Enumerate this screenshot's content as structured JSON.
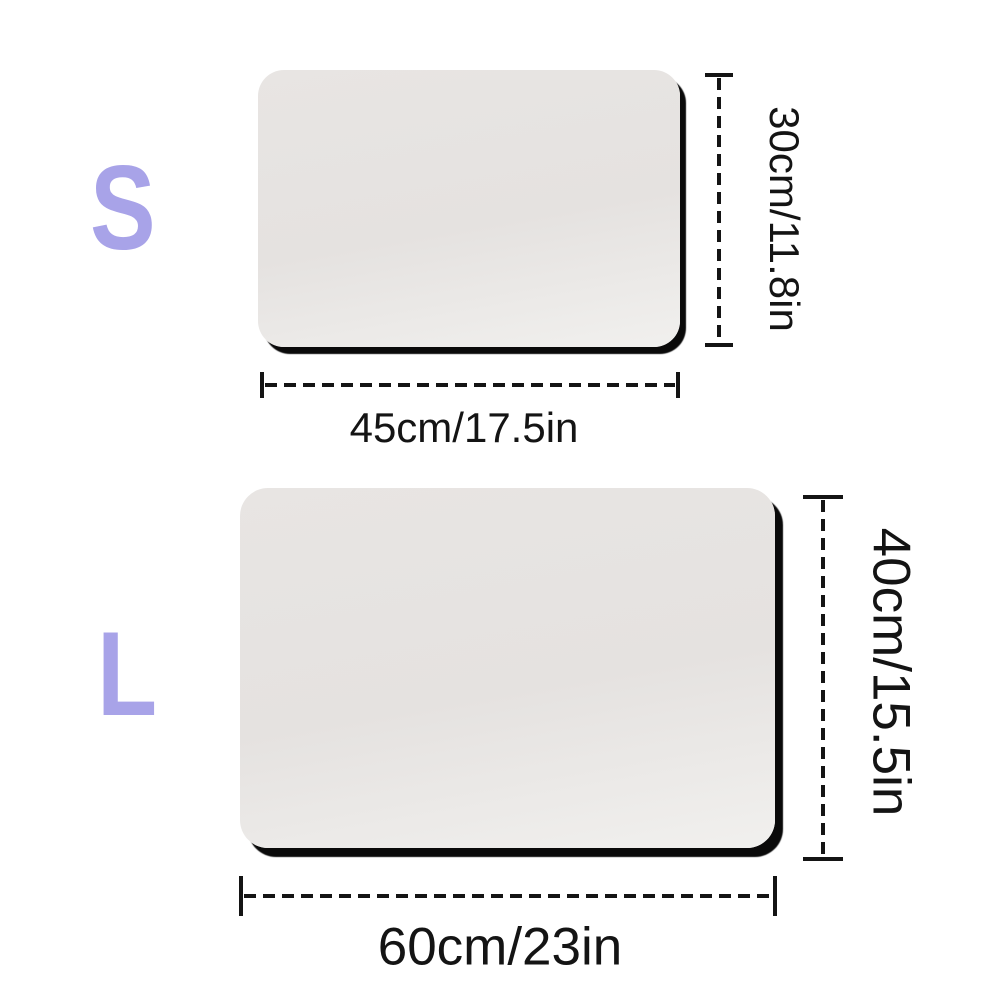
{
  "diagram": {
    "description_colors": {
      "background": "#ffffff",
      "size_letter_accent": "#a8a3e8",
      "dimension_line": "#141414",
      "mat_fill": "#e6e3e1",
      "mat_shadow": "#0a0a0a"
    },
    "sizes": [
      {
        "label": "S",
        "width_label": "45cm/17.5in",
        "height_label": "30cm/11.8in"
      },
      {
        "label": "L",
        "width_label": "60cm/23in",
        "height_label": "40cm/15.5in"
      }
    ]
  }
}
